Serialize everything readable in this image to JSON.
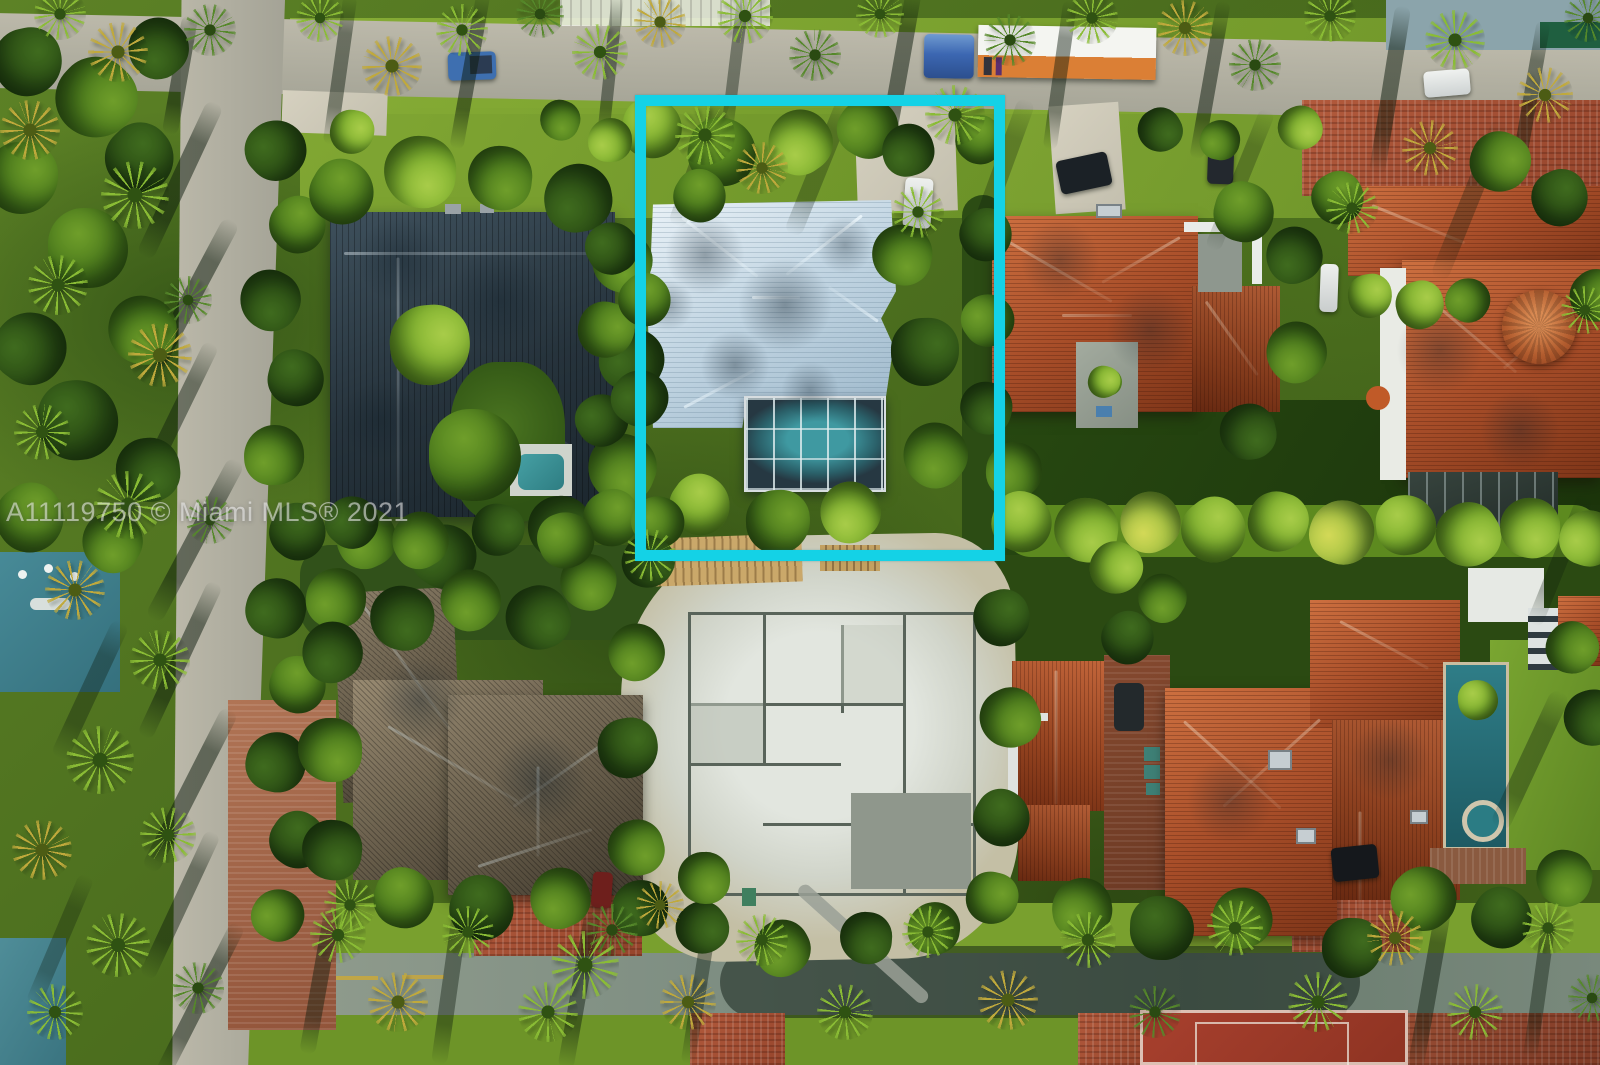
{
  "image": {
    "type": "aerial-drone-photograph",
    "subject": "residential neighborhood block with subject property outlined",
    "watermark": "A11119750 © Miami MLS® 2021",
    "highlight_box_color": "#14d2e6"
  },
  "colors": {
    "highlight_cyan": "#14d2e6",
    "white_metal_roof": "#c3d6e3",
    "dark_slate_roof": "#2b3a44",
    "terracotta_roof": "#a84e29",
    "brown_tile_roof": "#645a48",
    "pool_water_teal": "#2e8d8a",
    "asphalt_road": "#aeaca0",
    "grass_sunlit": "#86ac35",
    "grass_shadow": "#20400e",
    "construction_sand": "#d6dad2",
    "brick_paving": "#a85038",
    "sport_court_red": "#a03a2a"
  },
  "features": {
    "highlight_box_label": "subject-property-boundary",
    "subject_house": "white hip roof house with screened pool enclosure",
    "construction_site": "house foundation under construction",
    "moving_truck": "semi truck with orange trailer on top road",
    "sport_court": "red sport court at bottom right"
  }
}
